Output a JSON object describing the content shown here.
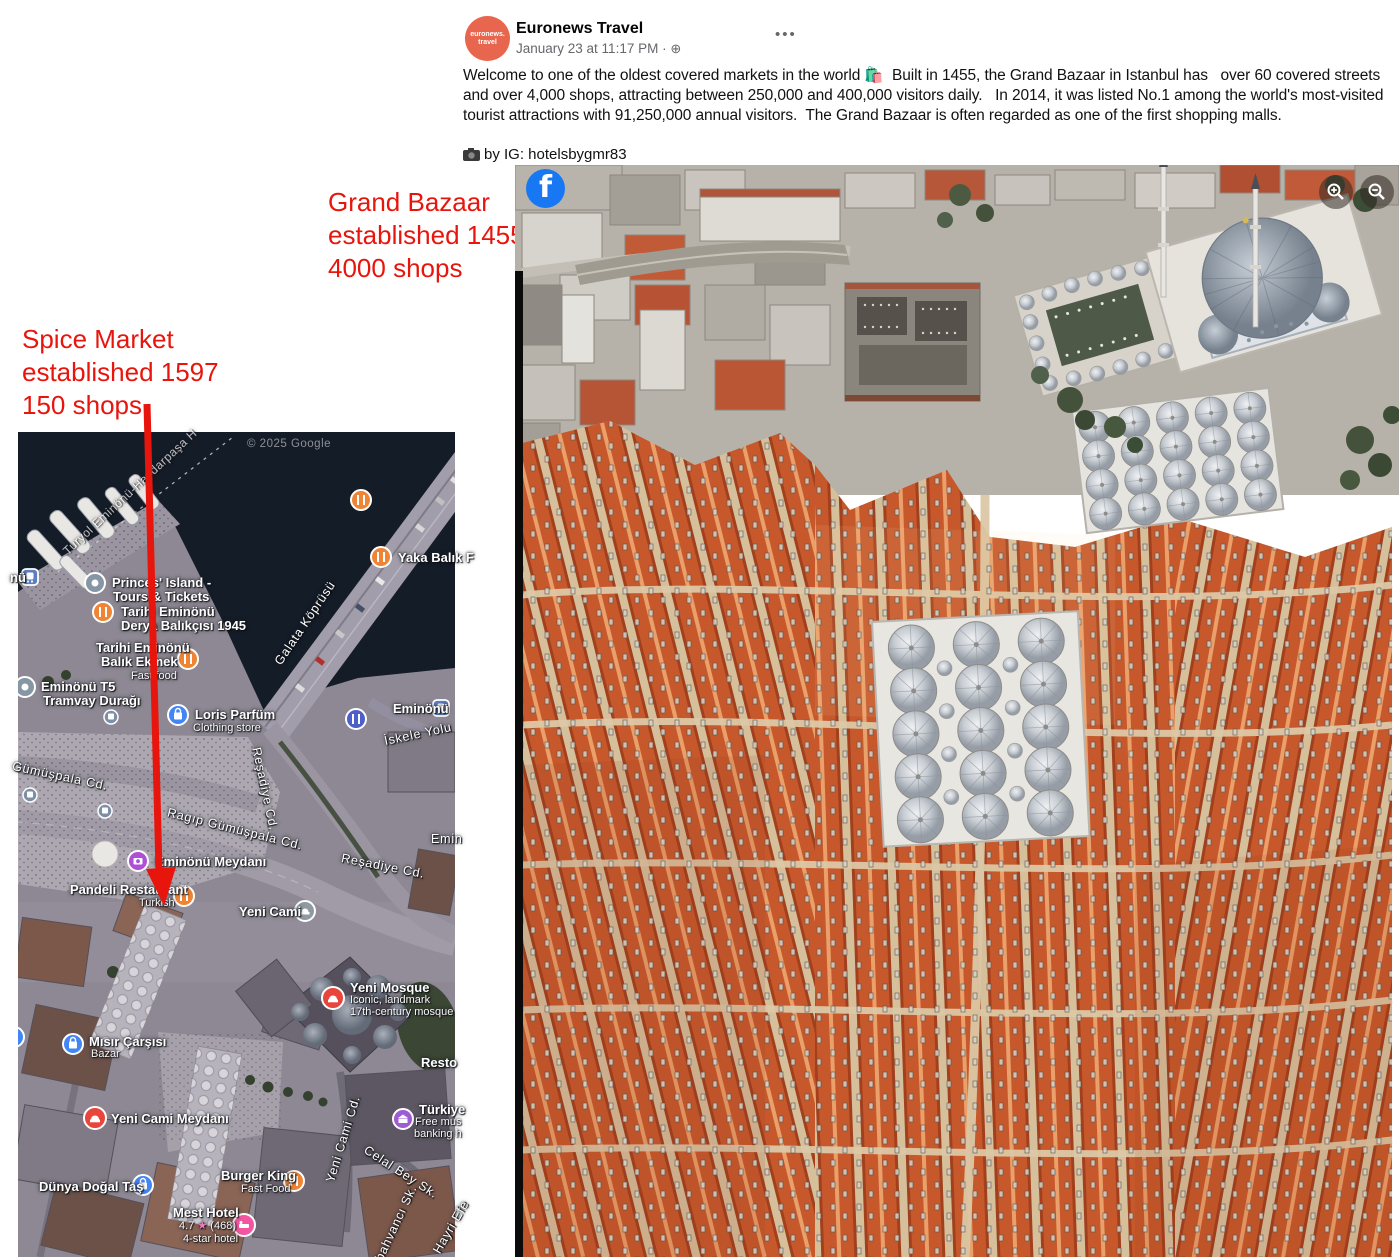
{
  "post": {
    "author": "Euronews Travel",
    "avatar_line1": "euronews.",
    "avatar_line2": "travel",
    "timestamp": "January 23 at 11:17 PM ·",
    "menu": "•••",
    "body": "Welcome to one of the oldest covered markets in the world 🛍️  Built in 1455, the Grand Bazaar in Istanbul has   over 60 covered streets and over 4,000 shops, attracting between 250,000 and 400,000 visitors daily.   In 2014, it was listed No.1 among the world's most-visited tourist attractions with 91,250,000 annual visitors.  The Grand Bazaar is often regarded as one of the first shopping malls.",
    "credit": "by IG: hotelsbygmr83"
  },
  "annotations": {
    "grand_bazaar": [
      "Grand Bazaar",
      "established 1455",
      "4000 shops"
    ],
    "spice_market": [
      "Spice Market",
      "established 1597",
      "150 shops"
    ],
    "accent_color": "#e8150d"
  },
  "map": {
    "copyright": "© 2025 Google",
    "ferry_route_label": "Turyol Eminönü-Haydarpaşa H",
    "streets": [
      {
        "label": "Galata Köprüsü"
      },
      {
        "label": "Reşadiye Cd."
      },
      {
        "label": "Reşadiye Cd."
      },
      {
        "label": "Gümüşpala Cd."
      },
      {
        "label": "Ragıp Gümüşpala Cd."
      },
      {
        "label": "İskele Yolu"
      },
      {
        "label": "Yeni Cami Cd."
      },
      {
        "label": "Celal Bey Sk."
      },
      {
        "label": "bahvancı Sk."
      },
      {
        "label": "Hayri Efe"
      },
      {
        "label": "Emin"
      }
    ],
    "pois": [
      {
        "name": "nü"
      },
      {
        "name": "Princes' Island -",
        "line2": "Tours & Tickets"
      },
      {
        "name": "Tarihi Eminönü",
        "line2": "Derya Balıkçısı 1945"
      },
      {
        "name": "Tarihi Eminönü",
        "line2": "Balık Ekmek",
        "sub": "Fast food"
      },
      {
        "name": "Eminönü T5",
        "line2": "Tramvay Durağı"
      },
      {
        "name": "Loris Parfüm",
        "sub": "Clothing store"
      },
      {
        "name": "Eminönü"
      },
      {
        "name": "Eminönü Meydanı"
      },
      {
        "name": "Pandeli Restaurant",
        "sub": "Turkish"
      },
      {
        "name": "Yeni Cami"
      },
      {
        "name": "Yeni Mosque",
        "sub": "Iconic, landmark",
        "sub2": "17th-century mosque"
      },
      {
        "name": "Mısır Çarşısı",
        "sub": "Bazar"
      },
      {
        "name": "Yeni Cami Meydanı"
      },
      {
        "name": "Dünya Doğal Taş"
      },
      {
        "name": "Burger King",
        "sub": "Fast Food"
      },
      {
        "name": "Mest Hotel",
        "rating": "4.7",
        "star": "★",
        "reviews": "(468)",
        "sub": "4-star hotel"
      },
      {
        "name": "Türkiye",
        "sub": "Free mus",
        "sub2": "banking h"
      },
      {
        "name": "Resto"
      },
      {
        "name": "Yaka Balık F"
      }
    ]
  },
  "photo": {
    "facebook_logo": "f"
  }
}
